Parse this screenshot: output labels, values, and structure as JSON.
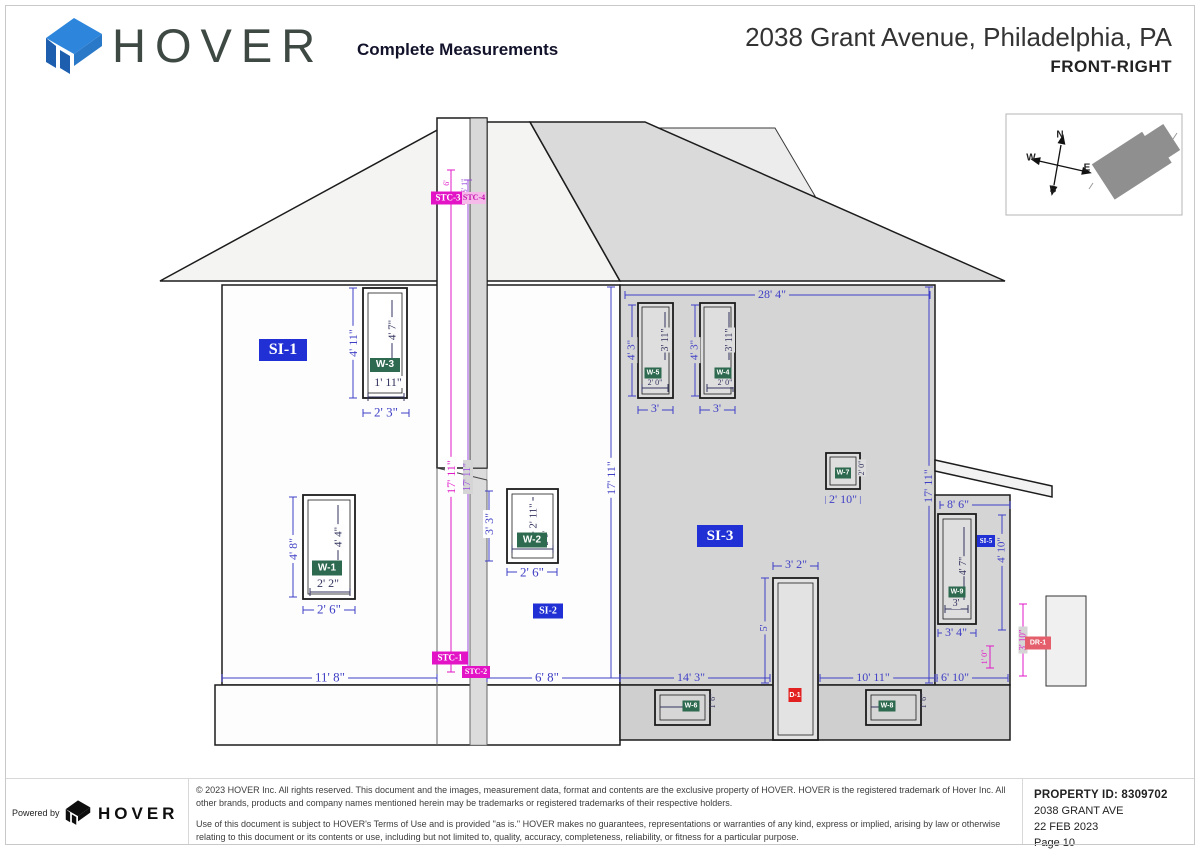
{
  "header": {
    "brand": "HOVER",
    "doc_type": "Complete Measurements",
    "address": "2038 Grant Avenue, Philadelphia, PA",
    "view_label": "FRONT-RIGHT"
  },
  "compass": {
    "n": "N",
    "s": "S",
    "e": "E",
    "w": "W"
  },
  "side_labels": {
    "si1": "SI-1",
    "si2": "SI-2",
    "si3": "SI-3",
    "si5": "SI-5"
  },
  "chimney_labels": {
    "stc1": "STC-1",
    "stc2": "STC-2",
    "stc3": "STC-3",
    "stc4": "STC-4"
  },
  "opening_labels": {
    "w1": "W-1",
    "w2": "W-2",
    "w3": "W-3",
    "w4": "W-4",
    "w5": "W-5",
    "w6": "W-6",
    "w7": "W-7",
    "w8": "W-8",
    "w9": "W-9",
    "d1": "D-1",
    "dr1": "DR-1"
  },
  "dims": {
    "top_width": "28' 4\"",
    "wall_h_left": "17' 11\"",
    "wall_h_right": "17' 11\"",
    "chimney_h1": "17' 11\"",
    "chimney_h2": "17' 11\"",
    "chimney_top1": "6'",
    "chimney_top2": "6' 1\"",
    "w3_outer_h": "4' 11\"",
    "w3_inner_h": "4' 7\"",
    "w3_inner_w": "1' 11\"",
    "w3_outer_w": "2' 3\"",
    "w1_outer_h": "4' 8\"",
    "w1_inner_h": "4' 4\"",
    "w1_inner_w": "2' 2\"",
    "w1_outer_w": "2' 6\"",
    "w2_outer_h": "3' 3\"",
    "w2_inner_h": "2' 11\"",
    "w2_side": "2' 0\"",
    "w2_outer_w": "2' 6\"",
    "w5_outer_h": "4' 3\"",
    "w5_inner_h": "3' 11\"",
    "w5_inner_w": "2' 0\"",
    "w5_outer_w": "3'",
    "w4_outer_h": "4' 3\"",
    "w4_inner_h": "3' 11\"",
    "w4_inner_w": "2' 0\"",
    "w4_outer_w": "3'",
    "w7_side": "2' 0\"",
    "w7_outer_w": "2' 10\"",
    "w9_inner_h": "4' 7\"",
    "w9_inner_w": "3'",
    "w9_outer_w": "3' 4\"",
    "w6_side": "1' 6\"",
    "w8_side": "1' 6\"",
    "door_w": "3' 2\"",
    "door_h": "5'",
    "bottom_11_8": "11' 8\"",
    "bottom_6_8": "6' 8\"",
    "bottom_14_3": "14' 3\"",
    "bottom_10_11": "10' 11\"",
    "bottom_6_10": "6' 10\"",
    "porch_w": "8' 6\"",
    "porch_h": "4' 10\"",
    "dr1_h": "3' 10\"",
    "dr1_w": "1' 0\""
  },
  "footer": {
    "powered_by": "Powered by",
    "brand": "HOVER",
    "copyright": "© 2023 HOVER Inc. All rights reserved. This document and the images, measurement data, format and contents are the exclusive property of HOVER. HOVER is the registered trademark of Hover Inc. All other brands, products and company names mentioned herein may be trademarks or registered trademarks of their respective holders.",
    "terms": "Use of this document is subject to HOVER's Terms of Use and is provided \"as is.\" HOVER makes no guarantees, representations or warranties of any kind, express or implied, arising by law or otherwise relating to this document or its contents or use, including but not limited to, quality, accuracy, completeness, reliability, or fitness for a particular purpose.",
    "property_id": "PROPERTY ID: 8309702",
    "address_line": "2038 GRANT AVE",
    "date": "22 FEB 2023",
    "page": "Page 10"
  }
}
